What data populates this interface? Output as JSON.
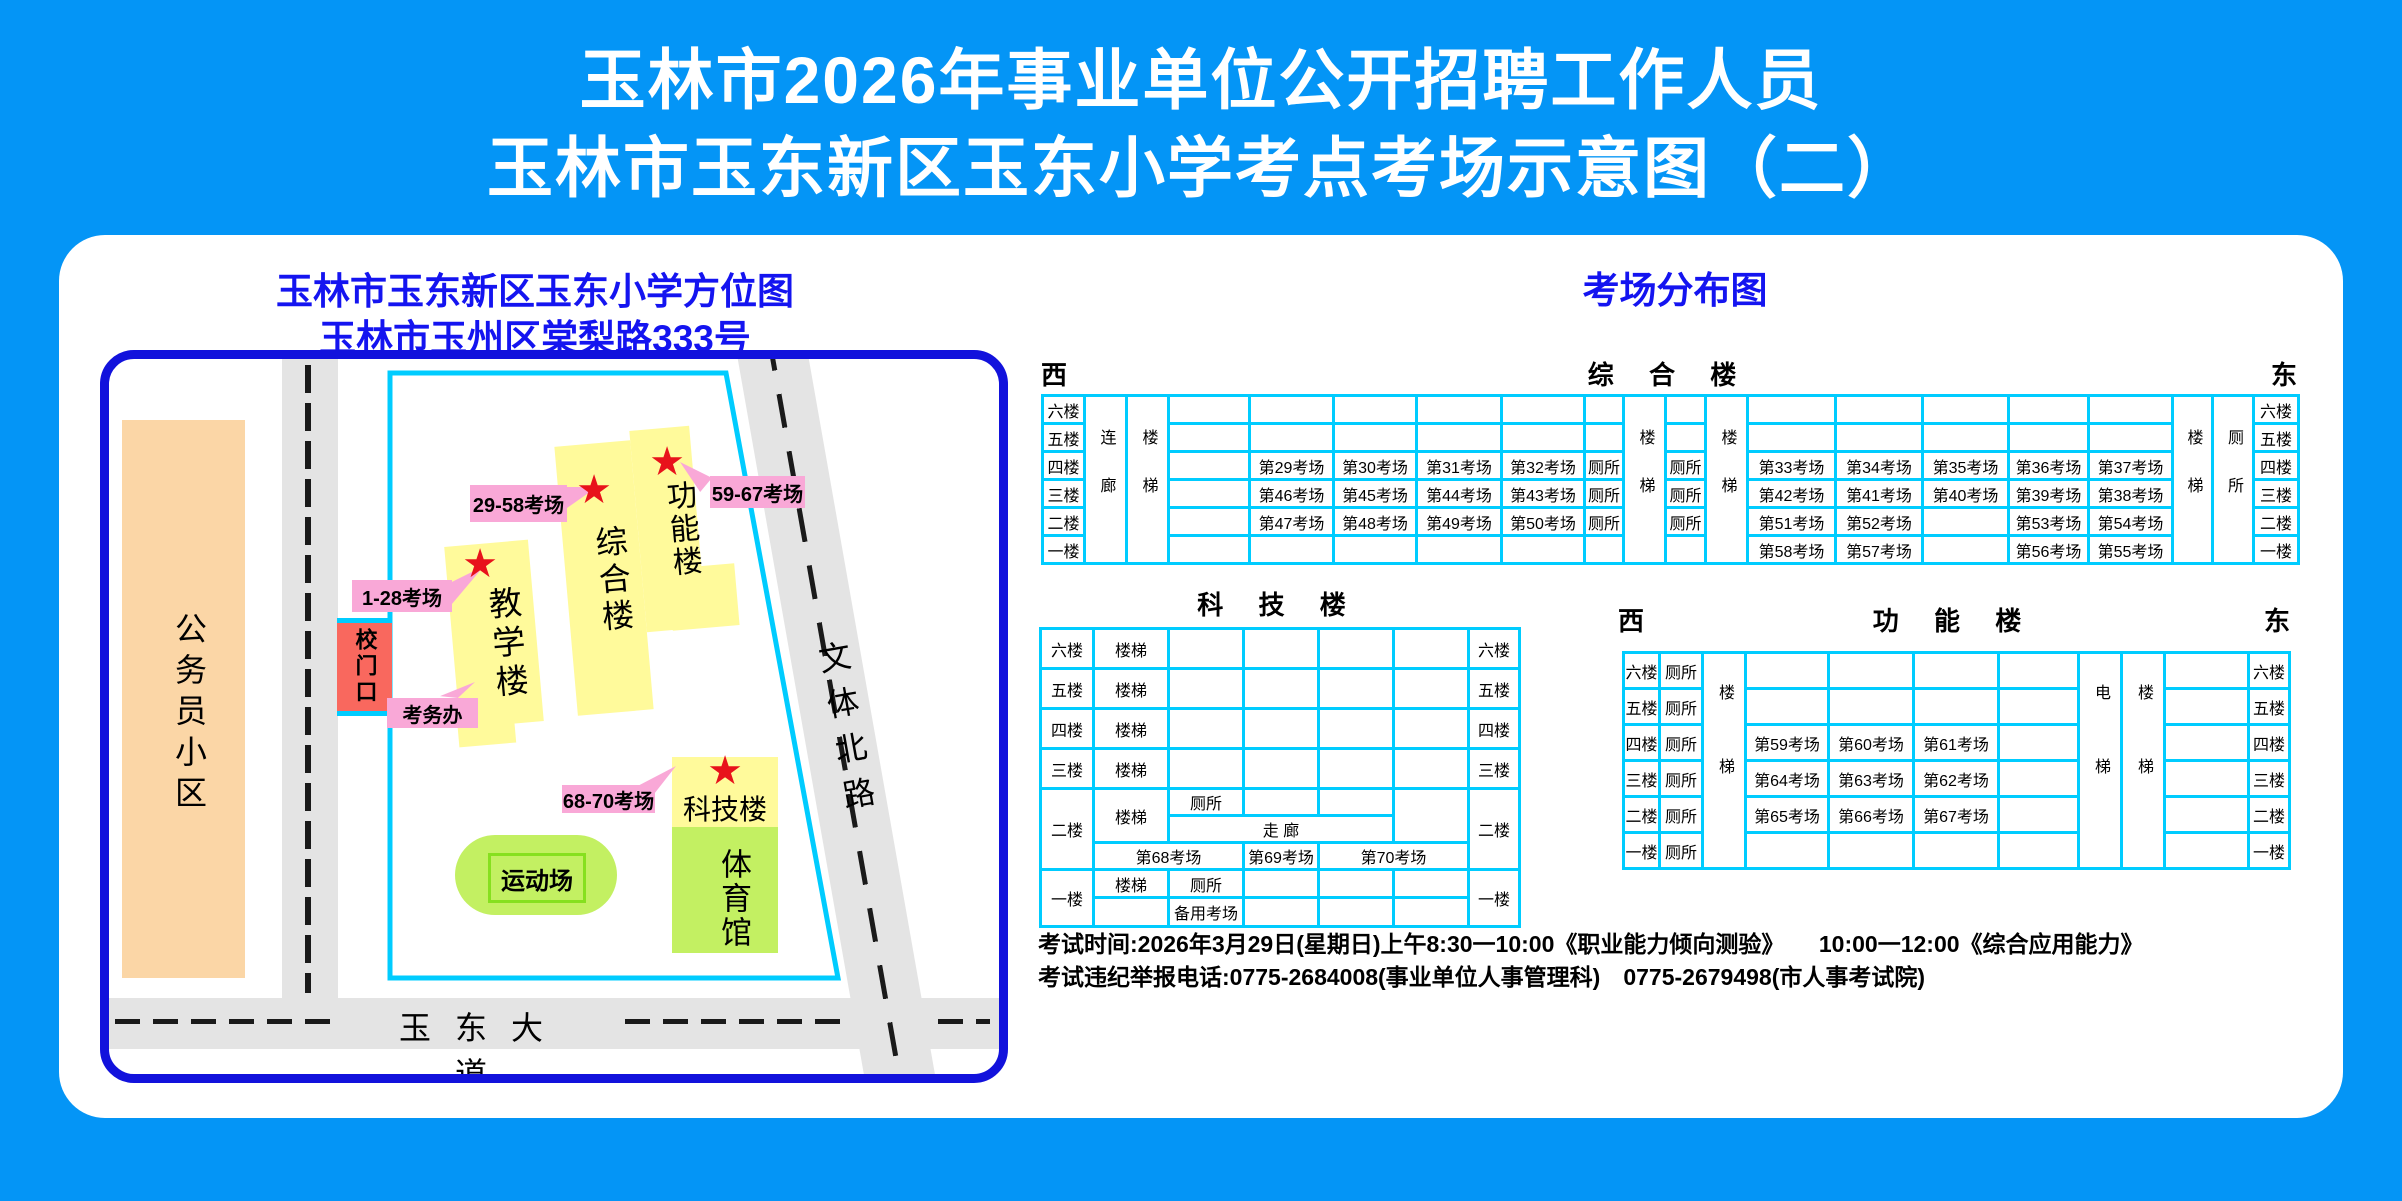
{
  "header": {
    "line1": "玉林市2026年事业单位公开招聘工作人员",
    "line2": "玉林市玉东新区玉东小学考点考场示意图（二）"
  },
  "map": {
    "title1": "玉林市玉东新区玉东小学方位图",
    "title2": "玉林市玉州区棠梨路333号",
    "community": "公务员小区",
    "gate": "校门口",
    "exam_office": "考务办",
    "teaching": "教学楼",
    "complex": "综合楼",
    "function": "功能楼",
    "science": "科技楼",
    "gym": "体育馆",
    "playground": "运动场",
    "road_south": "玉东大道",
    "road_east": "文体北路",
    "callout_teaching": "1-28考场",
    "callout_complex": "29-58考场",
    "callout_function": "59-67考场",
    "callout_science": "68-70考场"
  },
  "dist": {
    "title": "考场分布图",
    "west": "西",
    "east": "东",
    "floors": [
      "六楼",
      "五楼",
      "四楼",
      "三楼",
      "二楼",
      "一楼"
    ],
    "toilet": "厕所",
    "stairs": "楼梯",
    "elevator": "电梯",
    "corridor_link": "连廊",
    "corridor": "走 廊",
    "backup": "备用考场",
    "zonghe": {
      "name": "综 合 楼",
      "rows": [
        {
          "a": [
            "",
            "",
            "",
            ""
          ],
          "t1": "",
          "t2": "",
          "b": [
            "",
            "",
            "",
            "",
            ""
          ]
        },
        {
          "a": [
            "",
            "",
            "",
            ""
          ],
          "t1": "",
          "t2": "",
          "b": [
            "",
            "",
            "",
            "",
            ""
          ]
        },
        {
          "a": [
            "第29考场",
            "第30考场",
            "第31考场",
            "第32考场"
          ],
          "t1": "厕所",
          "t2": "厕所",
          "b": [
            "第33考场",
            "第34考场",
            "第35考场",
            "第36考场",
            "第37考场"
          ]
        },
        {
          "a": [
            "第46考场",
            "第45考场",
            "第44考场",
            "第43考场"
          ],
          "t1": "厕所",
          "t2": "厕所",
          "b": [
            "第42考场",
            "第41考场",
            "第40考场",
            "第39考场",
            "第38考场"
          ]
        },
        {
          "a": [
            "第47考场",
            "第48考场",
            "第49考场",
            "第50考场"
          ],
          "t1": "厕所",
          "t2": "厕所",
          "b": [
            "第51考场",
            "第52考场",
            "",
            "第53考场",
            "第54考场"
          ]
        },
        {
          "a": [
            "",
            "",
            "",
            ""
          ],
          "t1": "",
          "t2": "",
          "b": [
            "第58考场",
            "第57考场",
            "",
            "第56考场",
            "第55考场"
          ]
        }
      ]
    },
    "keji": {
      "name": "科 技 楼",
      "room68": "第68考场",
      "room69": "第69考场",
      "room70": "第70考场"
    },
    "gongneng": {
      "name": "功 能 楼",
      "rows": [
        [
          "",
          "",
          ""
        ],
        [
          "",
          "",
          ""
        ],
        [
          "第59考场",
          "第60考场",
          "第61考场"
        ],
        [
          "第64考场",
          "第63考场",
          "第62考场"
        ],
        [
          "第65考场",
          "第66考场",
          "第67考场"
        ],
        [
          "",
          "",
          ""
        ]
      ]
    }
  },
  "footer": {
    "line1": "考试时间:2026年3月29日(星期日)上午8:30一10:00《职业能力倾向测验》　　10:00一12:00《综合应用能力》",
    "line2": "考试违纪举报电话:0775-2684008(事业单位人事管理科)　0775-2679498(市人事考试院)"
  },
  "colors": {
    "background": "#0495F6",
    "panel": "#FFFFFF",
    "map_border": "#1212DC",
    "boundary_cyan": "#00CCFF",
    "table_border": "#00CCFF",
    "building_yellow": "#FFFA9B",
    "green": "#C3F062",
    "pink": "#F9A8D7",
    "gate_red": "#F9685E",
    "peach": "#FBD6A6",
    "road_gray": "#E4E4E4",
    "blue_text": "#1414F0",
    "star_red": "#E8121B"
  }
}
